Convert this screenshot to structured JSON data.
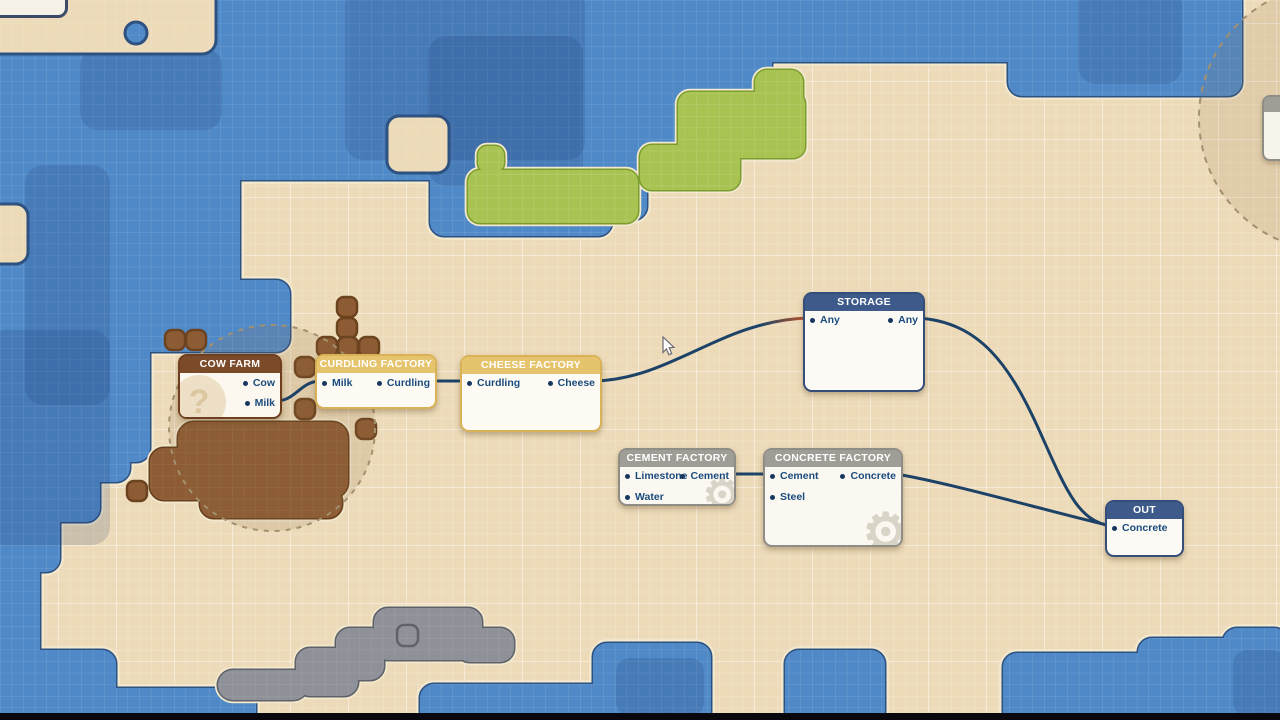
{
  "game": {
    "view": "factory-logistics-node-map",
    "colors": {
      "sand": "#ecdab8",
      "water": "#5089c7",
      "water_border": "#2d5282",
      "grass": "#a8c351",
      "grass_border": "#7d9c2f",
      "dirt": "#8d5c34",
      "dirt_border": "#66401c",
      "rock": "#8e9198",
      "rock_border": "#5f6168",
      "wire": "#1d4268",
      "wire_highlight": "#b4552f",
      "port_dot": "#17375f",
      "port_label": "#1b4b7e"
    }
  },
  "node_styles": {
    "brown": {
      "header": "#7b4a29",
      "border": "#6e3e1e",
      "body": "#fcf8ef"
    },
    "yellow": {
      "header": "#e6c46d",
      "border": "#d9b156",
      "body": "#fdfbf4"
    },
    "gray": {
      "header": "#9e9d96",
      "border": "#8e8d86",
      "body": "#faf8f1"
    },
    "navy": {
      "header": "#3d5a8a",
      "border": "#344e79",
      "body": "#fbfaf4"
    }
  },
  "nodes": [
    {
      "id": "cow-farm",
      "title": "COW FARM",
      "style": "brown",
      "x": 178,
      "y": 354,
      "w": 105,
      "h": 66,
      "watermark": "question-mark",
      "ports": [
        {
          "label": "Cow",
          "side": "out",
          "y": 381
        },
        {
          "label": "Milk",
          "side": "out",
          "y": 401
        }
      ]
    },
    {
      "id": "curdling-factory",
      "title": "CURDLING FACTORY",
      "style": "yellow",
      "x": 315,
      "y": 354,
      "w": 123,
      "h": 56,
      "ports": [
        {
          "label": "Milk",
          "side": "in",
          "y": 381
        },
        {
          "label": "Curdling",
          "side": "out",
          "y": 381
        }
      ]
    },
    {
      "id": "cheese-factory",
      "title": "CHEESE FACTORY",
      "style": "yellow",
      "x": 460,
      "y": 355,
      "w": 143,
      "h": 78,
      "ports": [
        {
          "label": "Curdling",
          "side": "in",
          "y": 381
        },
        {
          "label": "Cheese",
          "side": "out",
          "y": 381
        }
      ]
    },
    {
      "id": "storage",
      "title": "STORAGE",
      "style": "navy",
      "x": 803,
      "y": 292,
      "w": 123,
      "h": 101,
      "ports": [
        {
          "label": "Any",
          "side": "in",
          "y": 318
        },
        {
          "label": "Any",
          "side": "out",
          "y": 318
        }
      ]
    },
    {
      "id": "cement-factory",
      "title": "CEMENT FACTORY",
      "style": "gray",
      "x": 618,
      "y": 448,
      "w": 119,
      "h": 59,
      "watermark": "gear",
      "ports": [
        {
          "label": "Limestone",
          "side": "in",
          "y": 474
        },
        {
          "label": "Water",
          "side": "in",
          "y": 495
        },
        {
          "label": "Cement",
          "side": "out",
          "y": 474
        }
      ]
    },
    {
      "id": "concrete-factory",
      "title": "CONCRETE FACTORY",
      "style": "gray",
      "x": 763,
      "y": 448,
      "w": 141,
      "h": 100,
      "watermark": "gear",
      "ports": [
        {
          "label": "Cement",
          "side": "in",
          "y": 474
        },
        {
          "label": "Steel",
          "side": "in",
          "y": 495
        },
        {
          "label": "Concrete",
          "side": "out",
          "y": 474
        }
      ]
    },
    {
      "id": "out",
      "title": "OUT",
      "style": "navy",
      "x": 1105,
      "y": 500,
      "w": 80,
      "h": 58,
      "ports": [
        {
          "label": "Concrete",
          "side": "in",
          "y": 526
        }
      ]
    }
  ],
  "connections": [
    {
      "from": "cow-farm:Milk",
      "to": "curdling-factory:Milk",
      "path": "M276,401 C296,401 300,381 321,381"
    },
    {
      "from": "curdling-factory:Curdling",
      "to": "cheese-factory:Curdling",
      "path": "M430,381 C446,381 452,381 466,381"
    },
    {
      "from": "cheese-factory:Cheese",
      "to": "storage:Any",
      "path": "M595,381 C672,379 722,320 809,318",
      "gradient": true
    },
    {
      "from": "storage:Any",
      "to": "out:Concrete",
      "path": "M918,318 C980,322 1010,365 1040,432 C1066,490 1078,521 1111,526"
    },
    {
      "from": "concrete-factory:Concrete",
      "to": "out:Concrete",
      "path": "M896,474 C950,483 1040,509 1111,526"
    },
    {
      "from": "cement-factory:Cement",
      "to": "concrete-factory:Cement",
      "path": "M729,474 C744,474 754,474 769,474"
    }
  ],
  "cursor": {
    "x": 663,
    "y": 337
  },
  "offscreen_nodes": [
    {
      "position": "top-left-corner",
      "note": "partially visible node edge"
    },
    {
      "position": "right-edge",
      "note": "partially visible gray-header node inside dashed range circle"
    }
  ]
}
